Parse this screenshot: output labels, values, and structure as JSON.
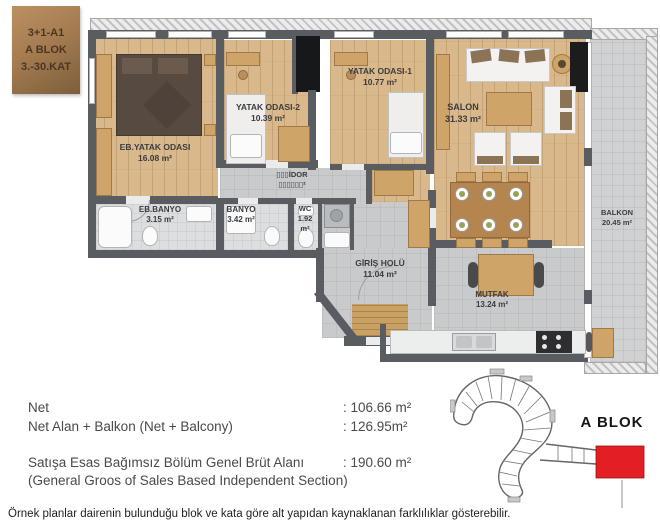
{
  "badge": {
    "line1": "3+1-A1",
    "line2": "A BLOK",
    "line3": "3.-30.KAT"
  },
  "plan": {
    "rooms": [
      {
        "name": "EB.YATAK ODASI",
        "area": "16.08 m²"
      },
      {
        "name": "YATAK ODASI-2",
        "area": "10.39 m²"
      },
      {
        "name": "YATAK ODASI-1",
        "area": "10.77 m²"
      },
      {
        "name": "SALON",
        "area": "31.33 m²"
      },
      {
        "name": "▯▯▯İDOR",
        "area": "▯▯▯▯▯▯²"
      },
      {
        "name": "EB.BANYO",
        "area": "3.15 m²"
      },
      {
        "name": "BANYO",
        "area": "3.42 m²"
      },
      {
        "name": "WC",
        "area": "1.92",
        "area2": "m²"
      },
      {
        "name": "GİRİŞ HOLÜ",
        "area": "11.04 m²"
      },
      {
        "name": "MUTFAK",
        "area": "13.24 m²"
      },
      {
        "name": "BALKON",
        "area": "20.45 m²"
      }
    ]
  },
  "areas": {
    "net_label": "Net",
    "net_value": ": 106.66 m²",
    "net_balcony_label": "Net Alan + Balkon (Net + Balcony)",
    "net_balcony_value": ": 126.95m²",
    "gross_label": "Satışa Esas Bağımsız Bölüm Genel Brüt Alanı",
    "gross_value": ": 190.60 m²",
    "gross_label_en": "(General Groos of Sales Based Independent Section)"
  },
  "key_plan": {
    "label": "A BLOK",
    "highlight_color": "#e31e24"
  },
  "footer": {
    "disclaimer": "Örnek planlar dairenin bulunduğu blok ve kata göre alt yapıdan kaynaklanan farklılıklar gösterebilir."
  },
  "colors": {
    "wall": "#595c60",
    "wood": "#d9b98c",
    "floor_gray": "#c8cacc",
    "bath": "#dcdee0",
    "balcony": "#cfd1d3",
    "furn": "#cfa468",
    "furn_border": "#a07946",
    "bed_dark": "#574a40",
    "highlight_red": "#e31e24",
    "hatch_a": "#c2c2c2",
    "hatch_b": "#ececec",
    "doormat": "#c9a263"
  }
}
